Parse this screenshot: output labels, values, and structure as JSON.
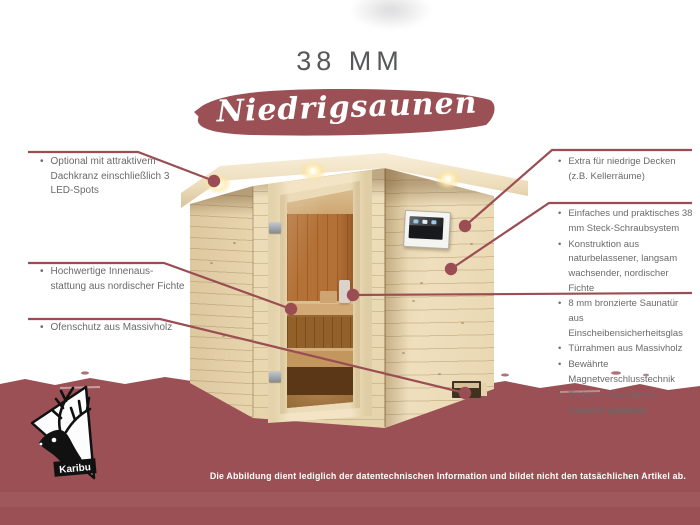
{
  "header": {
    "size_label": "38 MM",
    "banner_label": "Niedrigsaunen"
  },
  "callouts": {
    "left": [
      {
        "items": [
          "Optional mit attraktivem Dachkranz einschließlich 3 LED-Spots"
        ]
      },
      {
        "items": [
          "Hochwertige Innenaus-stattung aus nordischer Fichte"
        ]
      },
      {
        "items": [
          "Ofenschutz aus Massivholz"
        ]
      }
    ],
    "right": [
      {
        "items": [
          "Extra für niedrige Decken (z.B. Kellerräume)"
        ]
      },
      {
        "items": [
          "Einfaches und praktisches 38 mm Steck-Schraubsystem",
          "Konstruktion aus naturbelassener, langsam wachsender, nordischer Fichte"
        ]
      },
      {
        "items": [
          "8 mm bronzierte Saunatür aus Einscheibensicherheitsglas",
          "Türrahmen aus Massivholz",
          "Bewährte Magnetverschlusstechnik",
          "Türbeschläge mittels Exzenter justierbar"
        ]
      }
    ]
  },
  "logo": {
    "brand": "Karibu"
  },
  "footer": {
    "disclaimer": "Die Abbildung dient lediglich der datentechnischen Information und bildet nicht den tatsächlichen Artikel ab."
  },
  "colors": {
    "accent_maroon": "#9a5054",
    "callout_line": "#9a4e53",
    "text_gray": "#6a6a6a",
    "wood_light": "#ecdcba",
    "interior_orange": "#c67f3e"
  }
}
